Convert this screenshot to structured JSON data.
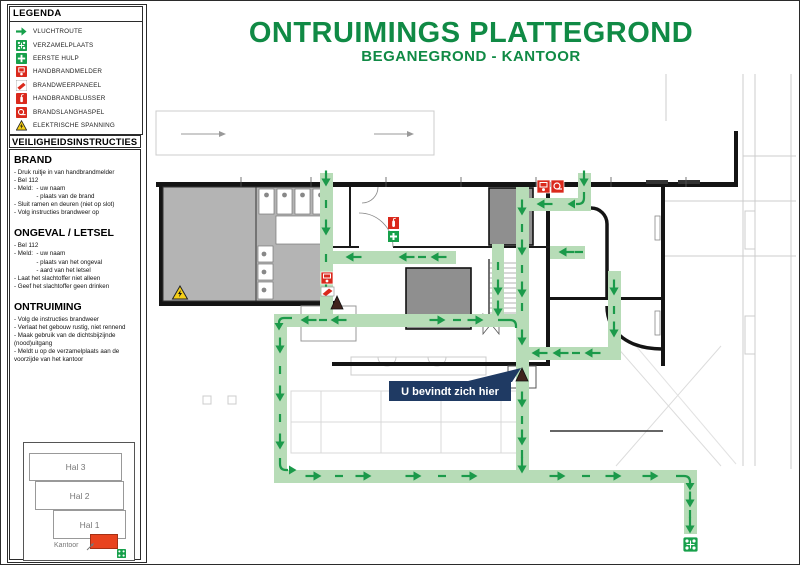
{
  "title": {
    "main": "ONTRUIMINGS PLATTEGROND",
    "subtitle": "BEGANEGROND - KANTOOR"
  },
  "legend": {
    "header": "LEGENDA",
    "items": [
      {
        "icon": "vluchtroute-icon",
        "label": "VLUCHTROUTE"
      },
      {
        "icon": "verzamelplaats-icon",
        "label": "VERZAMELPLAATS"
      },
      {
        "icon": "eerste-hulp-icon",
        "label": "EERSTE HULP"
      },
      {
        "icon": "handbrandmelder-icon",
        "label": "HANDBRANDMELDER"
      },
      {
        "icon": "brandweerpaneel-icon",
        "label": "BRANDWEERPANEEL"
      },
      {
        "icon": "handbrandblusser-icon",
        "label": "HANDBRANDBLUSSER"
      },
      {
        "icon": "brandslanghaspel-icon",
        "label": "BRANDSLANGHASPEL"
      },
      {
        "icon": "elektrische-spanning-icon",
        "label": "ELEKTRISCHE SPANNING"
      }
    ]
  },
  "instructions": {
    "header": "VEILIGHEIDSINSTRUCTIES",
    "sections": [
      {
        "title": "BRAND",
        "lines": [
          "- Druk ruitje in van handbrandmelder",
          "- Bel 112",
          "- Meld:  - uw naam",
          "             - plaats van de brand",
          "- Sluit ramen en deuren (niet op slot)",
          "- Volg instructies brandweer op"
        ]
      },
      {
        "title": "ONGEVAL / LETSEL",
        "lines": [
          "- Bel 112",
          "- Meld:  - uw naam",
          "             - plaats van het ongeval",
          "             - aard van het letsel",
          "- Laat het slachtoffer niet alleen",
          "- Geef het slachtoffer geen drinken"
        ]
      },
      {
        "title": "ONTRUIMING",
        "lines": [
          "- Volg de instructies brandweer",
          "- Verlaat het gebouw rustig, niet rennend",
          "- Maak gebruik van de dichtsbijzijnde (nood)uitgang",
          "- Meldt u op de verzamelplaats aan de voorzijde van het kantoor"
        ]
      }
    ]
  },
  "minimap": {
    "halls": [
      "Hal 3",
      "Hal 2",
      "Hal 1"
    ],
    "highlight_label": "Kantoor"
  },
  "plan": {
    "you_are_here": "U bevindt zich hier"
  },
  "colors": {
    "accent_green": "#108a45",
    "icon_green": "#17a04b",
    "icon_red": "#da291c",
    "route_fill": "#b7dcb7",
    "arrow_green": "#1b9a4a",
    "callout_navy": "#1f3a63",
    "warning_yellow": "#f5cf17",
    "room_gray": "#b4b4b4",
    "highlight_red": "#e8431e"
  }
}
